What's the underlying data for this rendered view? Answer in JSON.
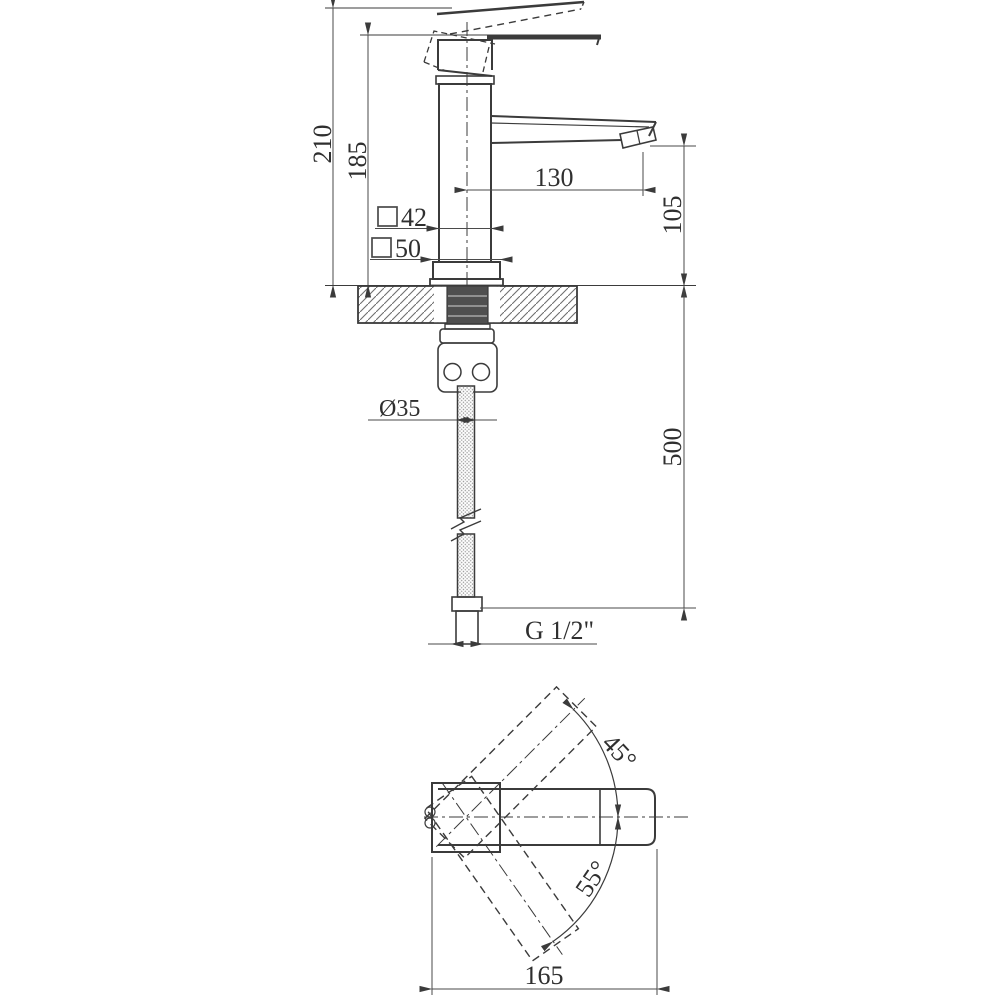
{
  "drawing": {
    "type": "technical-dimension-drawing",
    "subject": "single-lever basin faucet (front elevation and plan view)",
    "line_color": "#3b3b3b",
    "background": "#ffffff",
    "front_view": {
      "dims": {
        "height_total": "210",
        "height_body": "185",
        "spout_reach": "130",
        "spout_height": "105",
        "hose_length": "500",
        "body_square_value": "42",
        "base_square_value": "50",
        "mount_hole_diameter": "Ø35",
        "thread_size": "G 1/2\""
      }
    },
    "top_view": {
      "dims": {
        "handle_swing_up": "45°",
        "handle_swing_down": "55°",
        "overall_length": "165"
      }
    }
  }
}
